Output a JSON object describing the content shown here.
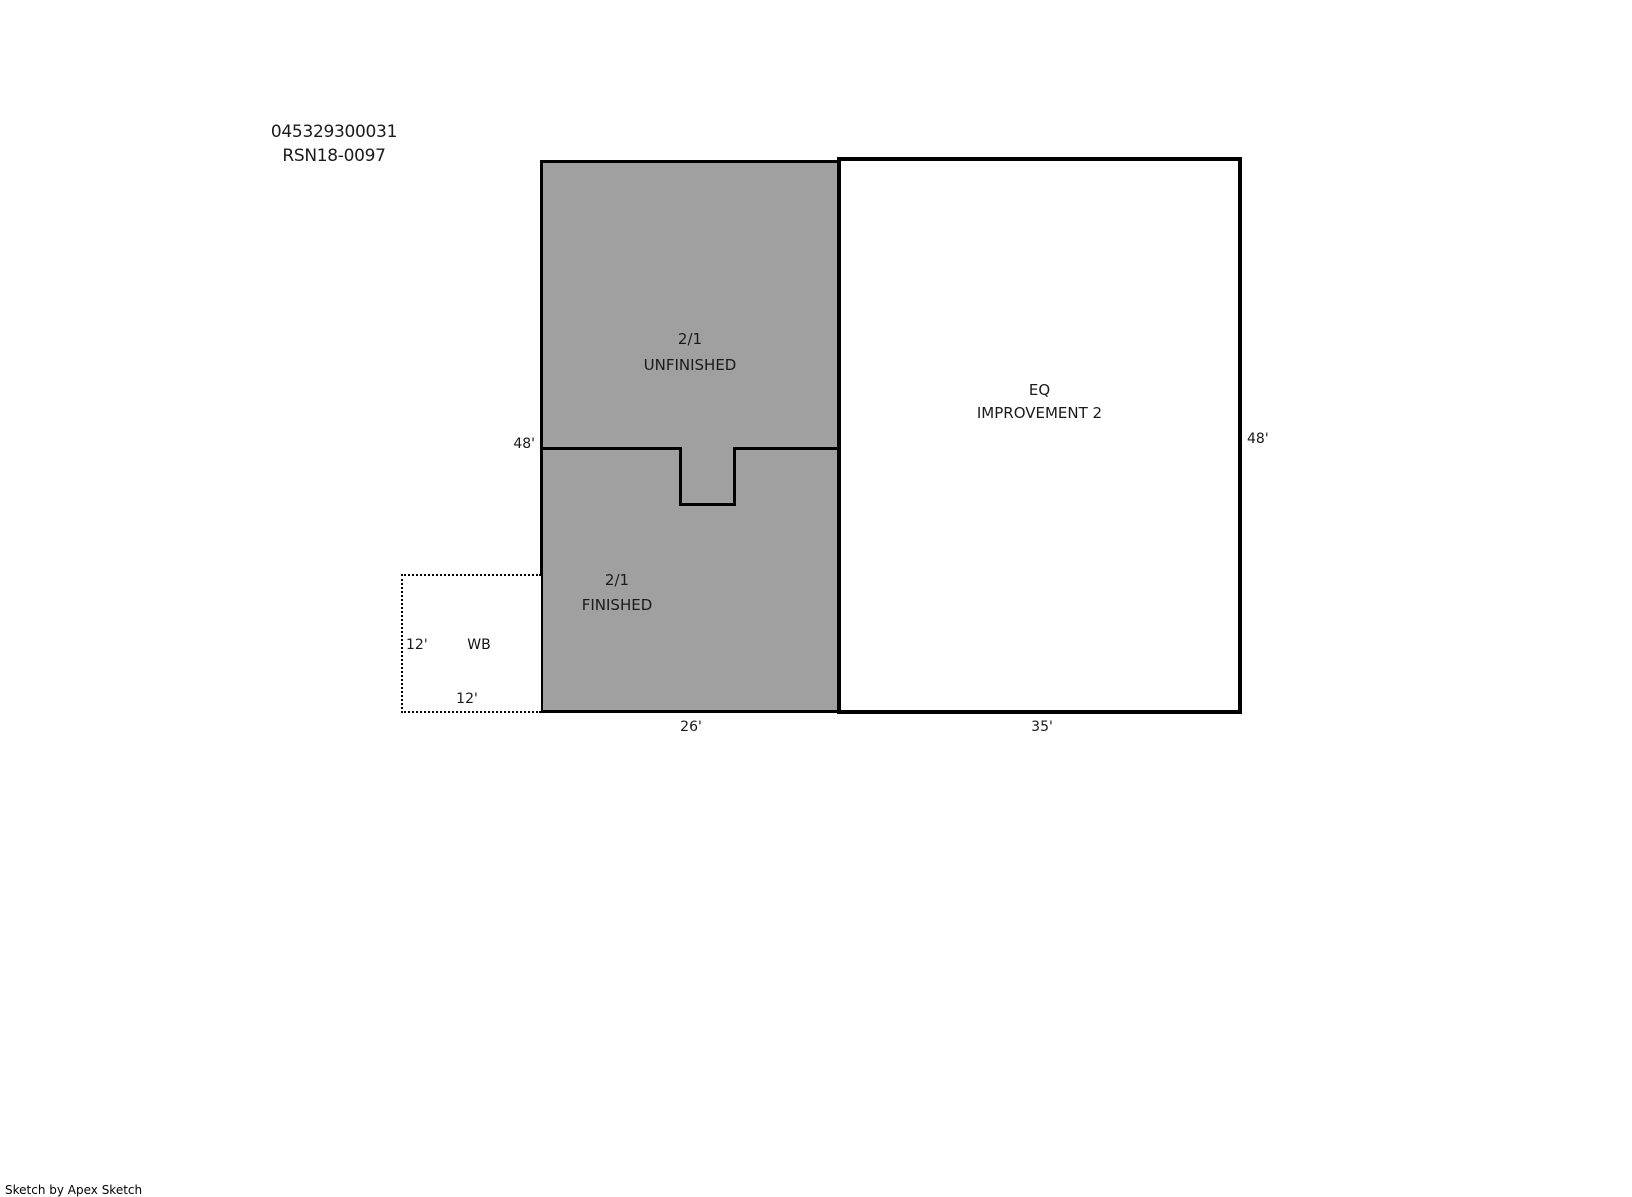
{
  "header": {
    "parcel_id": "045329300031",
    "rsn": "RSN18-0097"
  },
  "areas": {
    "unfinished": {
      "line1": "2/1",
      "line2": "UNFINISHED"
    },
    "finished": {
      "line1": "2/1",
      "line2": "FINISHED"
    },
    "improvement2": {
      "line1": "EQ",
      "line2": "IMPROVEMENT 2"
    },
    "wb": {
      "label": "WB"
    }
  },
  "dimensions": {
    "basement_height": "48'",
    "improvement_height": "48'",
    "basement_width": "26'",
    "improvement_width": "35'",
    "wb_height": "12'",
    "wb_width": "12'"
  },
  "footer": {
    "credit": "Sketch by Apex Sketch"
  },
  "colors": {
    "area_fill": "#a0a0a0",
    "outline": "#000000",
    "background": "#ffffff",
    "text": "#1a1a1a"
  }
}
